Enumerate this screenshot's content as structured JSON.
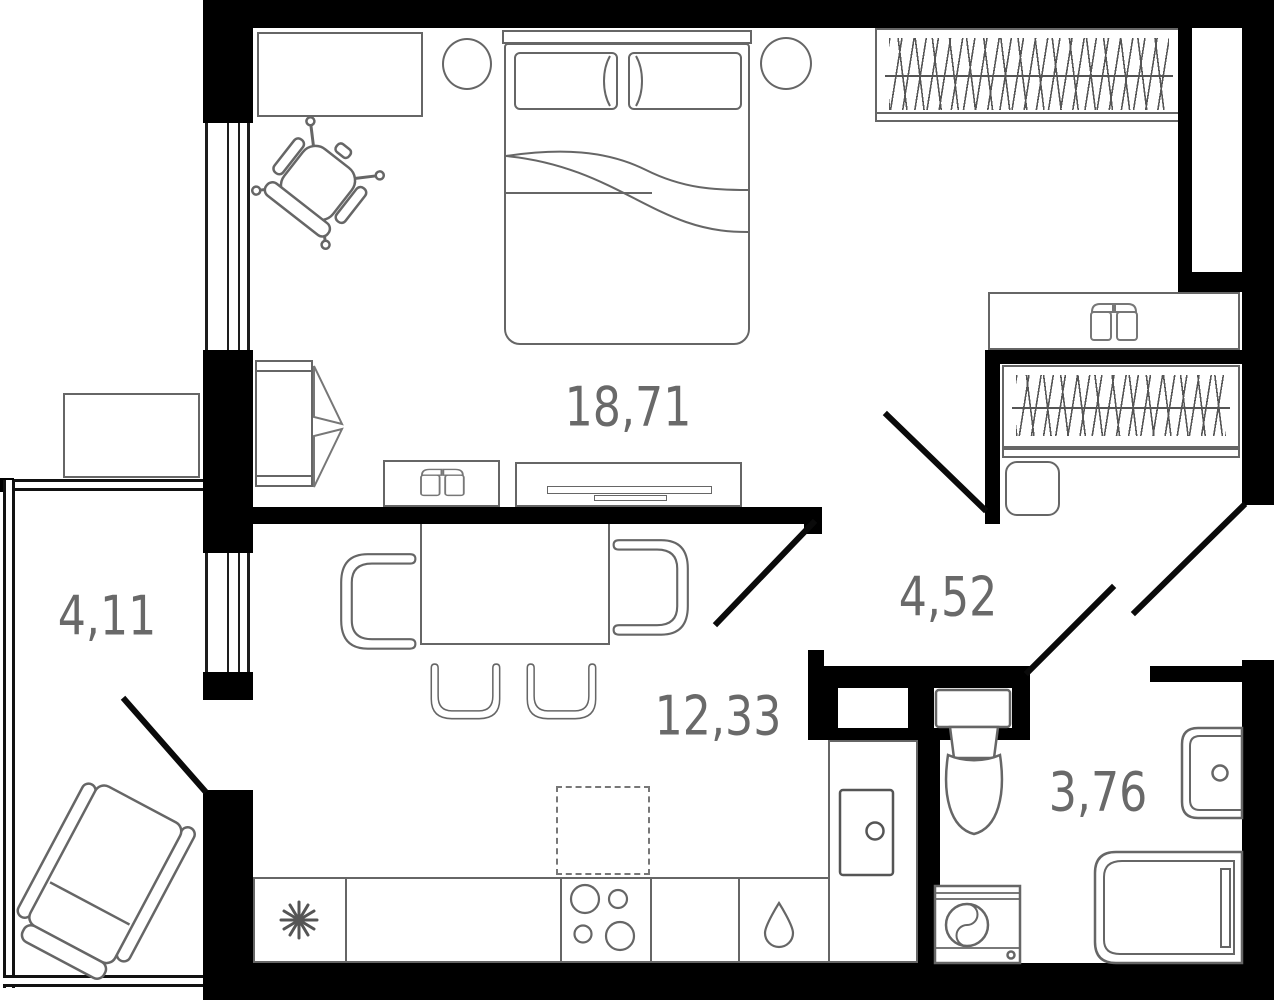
{
  "plan": {
    "type": "apartment-floor-plan",
    "rooms": {
      "bedroom": {
        "area_label": "18,71"
      },
      "living_kitchen": {
        "area_label": "12,33"
      },
      "hall": {
        "area_label": "4,52"
      },
      "bathroom": {
        "area_label": "3,76"
      },
      "balcony": {
        "area_label": "4,11"
      }
    },
    "colors": {
      "wall": "#000000",
      "furniture_line": "#666666",
      "label_text": "#696969"
    }
  }
}
